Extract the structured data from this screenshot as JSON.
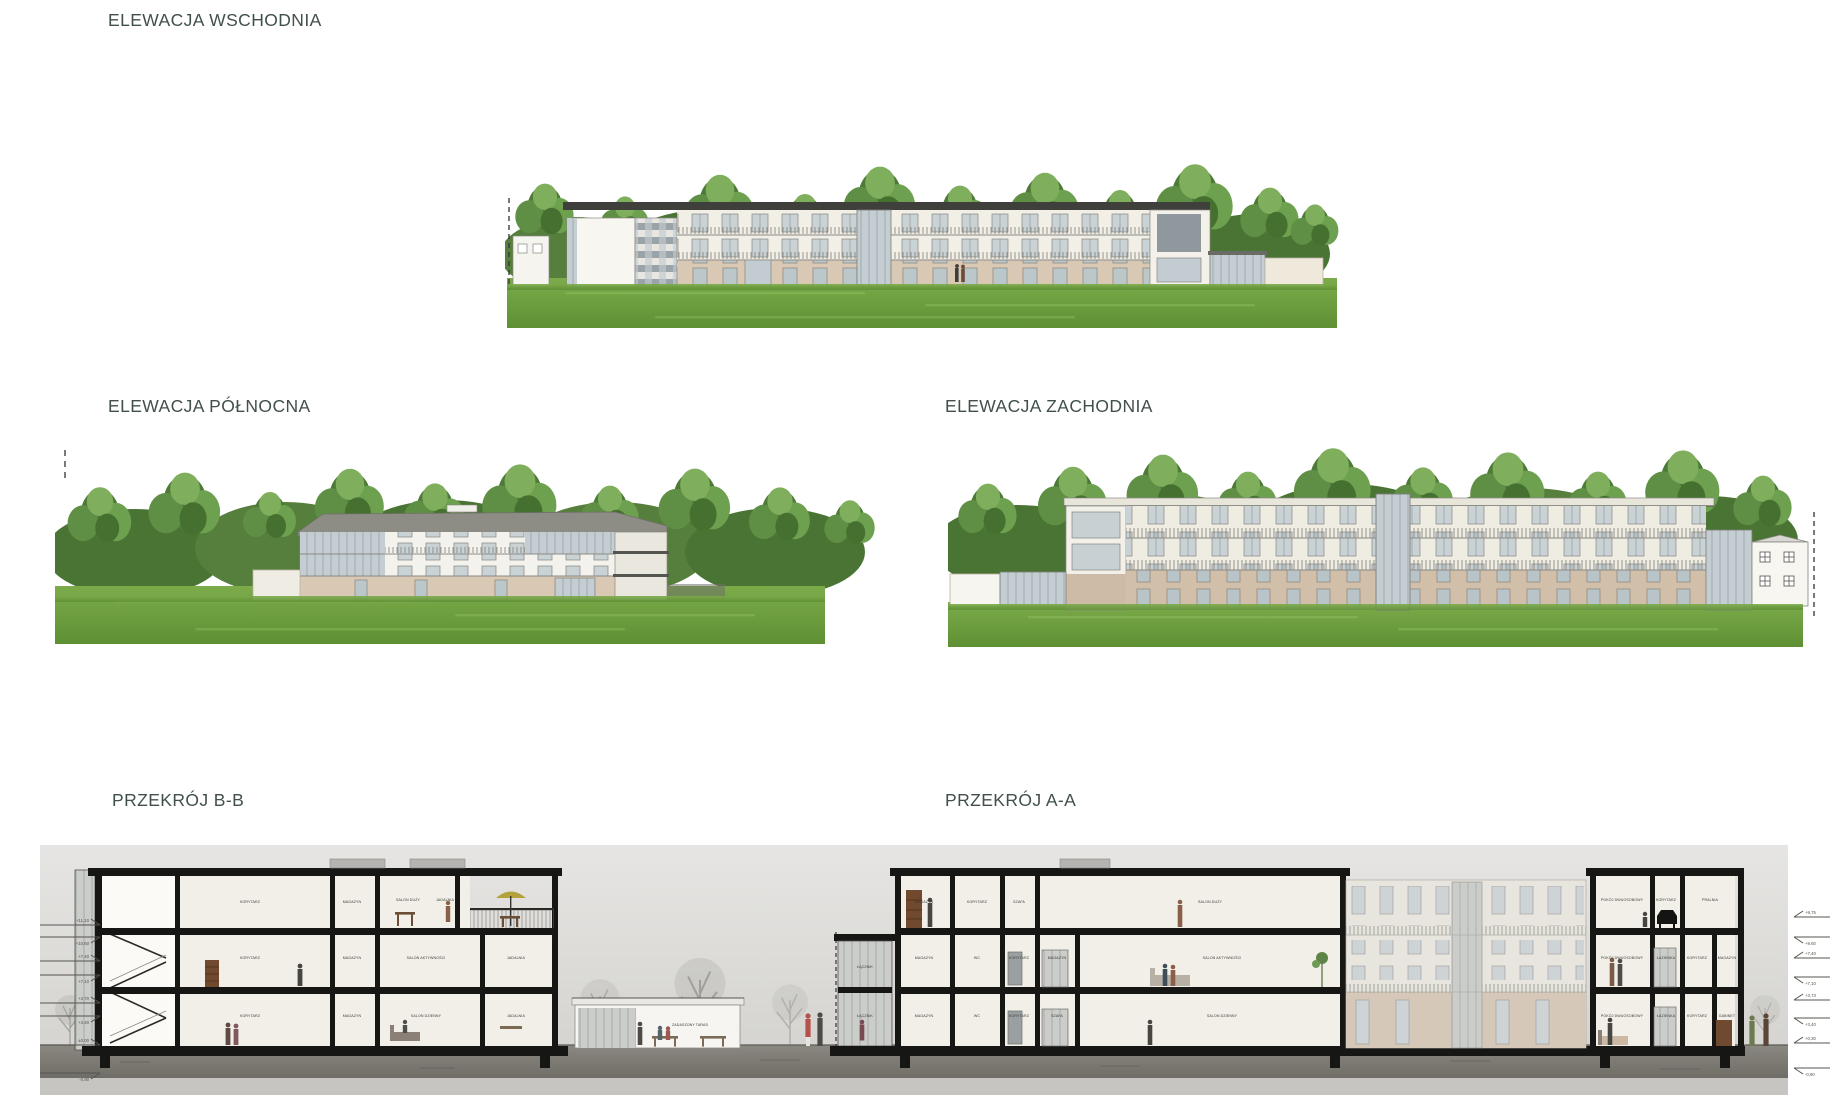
{
  "titles": {
    "east": "ELEWACJA WSCHODNIA",
    "north": "ELEWACJA PÓŁNOCNA",
    "west": "ELEWACJA ZACHODNIA",
    "bb": "PRZEKRÓJ B-B",
    "aa": "PRZEKRÓJ A-A"
  },
  "bb": {
    "floors": [
      [
        "KORYTARZ",
        "MAGAZYN",
        "SALON DUŻY",
        "JADALNIA"
      ],
      [
        "KORYTARZ",
        "MAGAZYN",
        "SALON AKTYWNOŚCI",
        "JADALNIA"
      ],
      [
        "KORYTARZ",
        "MAGAZYN",
        "SALON DZIENNY",
        "JADALNIA"
      ]
    ],
    "annex": "ZADASZONY TARAS"
  },
  "aa": {
    "connector": [
      "ŁĄCZNIK",
      "ŁĄCZNIK"
    ],
    "left": [
      [
        "MAGAZYN",
        "KORYTARZ",
        "SZAFA",
        "SALON DUŻY"
      ],
      [
        "MAGAZYN",
        "WC",
        "KORYTARZ",
        "MAGAZYN",
        "SALON AKTYWNOŚCI"
      ],
      [
        "MAGAZYN",
        "WC",
        "KORYTARZ",
        "SZAFA",
        "SALON DZIENNY"
      ]
    ],
    "right": [
      [
        "POKÓJ DWUOSOBOWY",
        "KORYTARZ",
        "PRALNIA"
      ],
      [
        "POKÓJ DWUOSOBOWY",
        "ŁAZIENKA",
        "KORYTARZ",
        "MAGAZYN"
      ],
      [
        "POKÓJ DWUOSOBOWY",
        "ŁAZIENKA",
        "KORYTARZ",
        "GABINET"
      ]
    ]
  },
  "levels": {
    "left": [
      "+11,10",
      "+10,60",
      "+7,40",
      "+7,10",
      "+3,70",
      "+3,40",
      "±0,00",
      "-0,90"
    ],
    "right": [
      "+9,75",
      "+9,60",
      "+7,40",
      "+7,10",
      "+3,73",
      "+3,40",
      "+0,30",
      "-0,90"
    ]
  },
  "colors": {
    "title": "#415049",
    "tree": "#5c8a3f",
    "lawn": "#6fa23e",
    "wall": "#efebdf",
    "base": "#d8c7b2",
    "glass": "#c3cdd1",
    "roof": "#3f3f3c",
    "section_bg": "#dedddb",
    "slab": "#161614"
  }
}
